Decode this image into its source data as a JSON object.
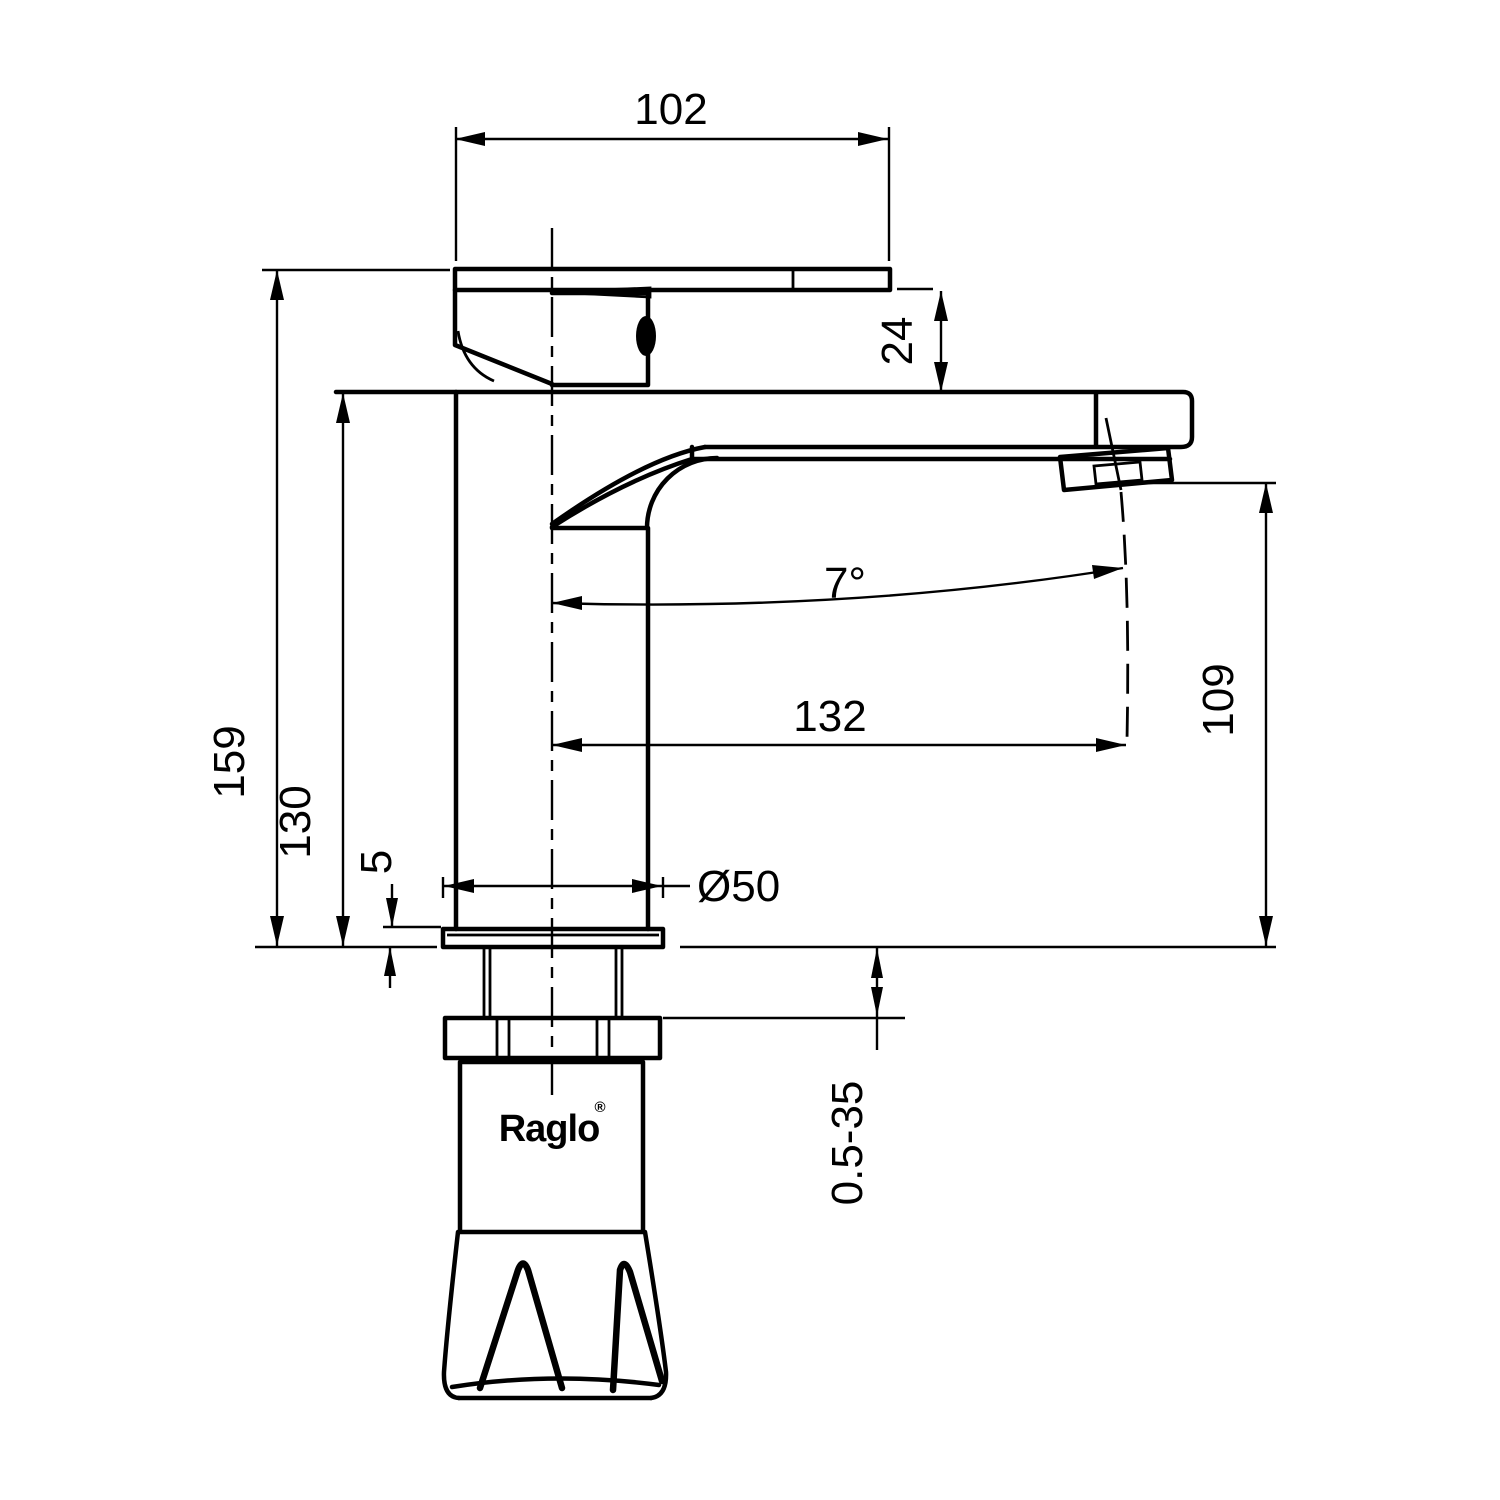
{
  "drawing": {
    "type": "faucet-technical-drawing",
    "brand": "Raglo",
    "registered_mark": "®",
    "colors": {
      "line": "#000000",
      "background": "#ffffff"
    },
    "dimensions": {
      "handle_spout_width": "102",
      "handle_drop": "24",
      "total_height": "159",
      "body_height": "130",
      "spout_angle": "7°",
      "spout_reach": "132",
      "outlet_height": "109",
      "base_diameter": "Ø50",
      "base_plate_thickness": "5",
      "mounting_thickness_range": "0.5-35"
    }
  }
}
